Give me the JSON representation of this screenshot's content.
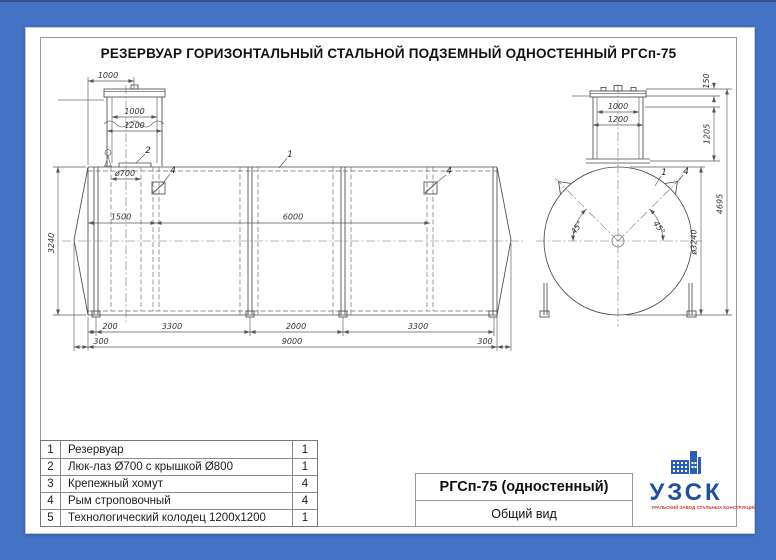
{
  "header": {
    "title": "РЕЗЕРВУАР ГОРИЗОНТАЛЬНЫЙ СТАЛЬНОЙ ПОДЗЕМНЫЙ ОДНОСТЕННЫЙ РГСп-75"
  },
  "colors": {
    "background": "#4472c4",
    "line": "#4a4a4a",
    "logo_blue": "#1c4f9f",
    "logo_red": "#c9372e"
  },
  "side_view": {
    "dims": {
      "offset_top": "1000",
      "well_top_width": "1000",
      "well_width": "1200",
      "manhole_dia": "ø700",
      "shell_dia": "3240",
      "lug_offset": "1500",
      "lug_spacing": "6000",
      "leg_offset": "200",
      "leg_span_1": "3300",
      "leg_span_mid": "2000",
      "leg_span_2": "3300",
      "end_left": "300",
      "shell_length": "9000",
      "end_right": "300"
    }
  },
  "end_view": {
    "dims": {
      "well_top_width": "1000",
      "well_width": "1200",
      "cover_height": "150",
      "neck_height": "1205",
      "total_height": "4695",
      "shell_dia": "ø3240",
      "lug_angle": "45°"
    }
  },
  "callouts": {
    "reservoir": "1",
    "manhole": "2",
    "lug": "4"
  },
  "parts_table": {
    "rows": [
      {
        "no": "1",
        "name": "Резервуар",
        "qty": "1"
      },
      {
        "no": "2",
        "name": "Люк-лаз Ø700 с крышкой Ø800",
        "qty": "1"
      },
      {
        "no": "3",
        "name": "Крепежный хомут",
        "qty": "4"
      },
      {
        "no": "4",
        "name": "Рым строповочный",
        "qty": "4"
      },
      {
        "no": "5",
        "name": "Технологический колодец 1200x1200",
        "qty": "1"
      }
    ]
  },
  "title_block": {
    "model": "РГСп-75 (одностенный)",
    "view_name": "Общий вид"
  },
  "logo": {
    "name": "УЗСК",
    "tagline": "УРАЛЬСКИЙ ЗАВОД СТАЛЬНЫХ КОНСТРУКЦИЙ"
  }
}
